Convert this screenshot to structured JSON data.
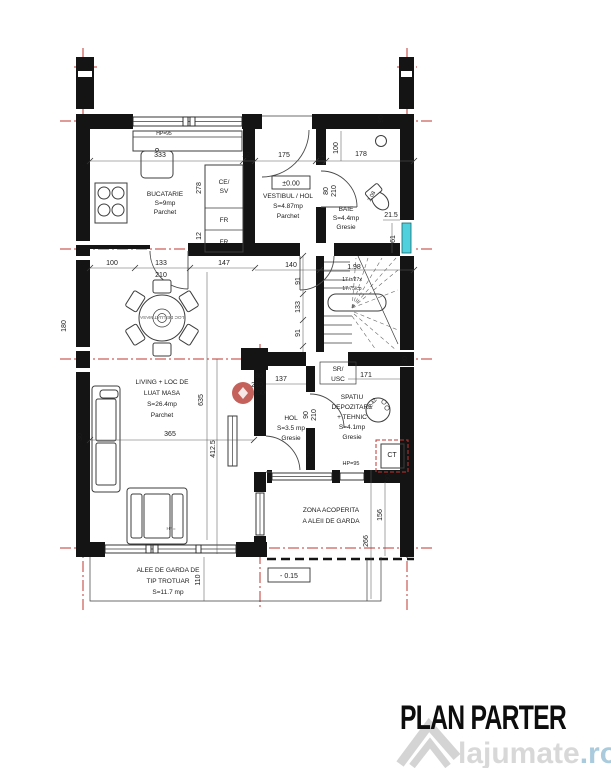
{
  "title": "PLAN PARTER",
  "watermark": {
    "brand": "lajumate",
    "tld": ".ro"
  },
  "colors": {
    "axis_red": "#c23531",
    "window_cyan": "#4fd0dc",
    "wall_black": "#141414",
    "watermark_gray": "#d8d8d8",
    "watermark_blue": "#a9cbdd",
    "logo_red": "#bc4b43"
  },
  "levels": {
    "ground": "±0.00",
    "terrace": "- 0.15"
  },
  "rooms": {
    "bucatarie": {
      "lines": [
        "BUCATARIE",
        "S=9mp",
        "Parchet"
      ]
    },
    "vestibul": {
      "lines": [
        "VESTIBUL / HOL",
        "S=4.87mp",
        "Parchet"
      ]
    },
    "baie": {
      "lines": [
        "BAIE",
        "S=4.4mp",
        "Gresie"
      ]
    },
    "living": {
      "lines": [
        "LIVING + LOC DE",
        "LUAT MASA",
        "S=26.4mp",
        "Parchet"
      ]
    },
    "hol": {
      "lines": [
        "HOL",
        "S=3.5 mp",
        "Gresie"
      ]
    },
    "depozitare": {
      "lines": [
        "SPATIU",
        "DEPOZITARE",
        "+ TEHNIC",
        "S=4.1mp",
        "Gresie"
      ]
    },
    "sr_usc": {
      "lines": [
        "SR/",
        "USC"
      ]
    },
    "zona": {
      "lines": [
        "ZONA ACOPERITA",
        "A ALEII DE GARDA"
      ]
    },
    "alee": {
      "lines": [
        "ALEE DE GARDA DE",
        "TIP TROTUAR",
        "S=11.7 mp"
      ]
    }
  },
  "fixtures": {
    "cab1a": "CE/",
    "cab1b": "SV",
    "cab2": "FR",
    "cab3": "FR",
    "boiler": "CT",
    "table_label": "LOC DE LUAT MASA"
  },
  "stairs": {
    "h": "1.98",
    "note1": "17 tr/27x",
    "note2": "17.75/cp"
  },
  "windows": {
    "hp_top": "HP=95",
    "hp_mid": "HP=95",
    "hp_bot": "HP="
  },
  "dims": {
    "t1": "333",
    "t2": "12",
    "t3": "175",
    "t4": "12",
    "t5": "178",
    "v100": "100",
    "b90": "90",
    "vb80": "80",
    "vb210": "210",
    "k278": "278",
    "k12": "12",
    "kb100": "100",
    "kb133": "133",
    "kb210": "210",
    "kb147": "147",
    "h140": "140",
    "b21_5": "21.5",
    "b61": "61",
    "b208": "2.08",
    "s91a": "91",
    "s133": "133",
    "s91b": "91",
    "m80": "80",
    "m210": "210",
    "m137": "137",
    "m150": "150",
    "m171": "171",
    "hd90": "90",
    "hd210": "210",
    "h76": "76",
    "d242": "2.42",
    "l635": "635",
    "l412": "412.5",
    "l365": "365",
    "l180": "180",
    "l30": "30",
    "r30": "30",
    "z80": "80",
    "z156": "156",
    "z266": "266",
    "a110": "110"
  }
}
